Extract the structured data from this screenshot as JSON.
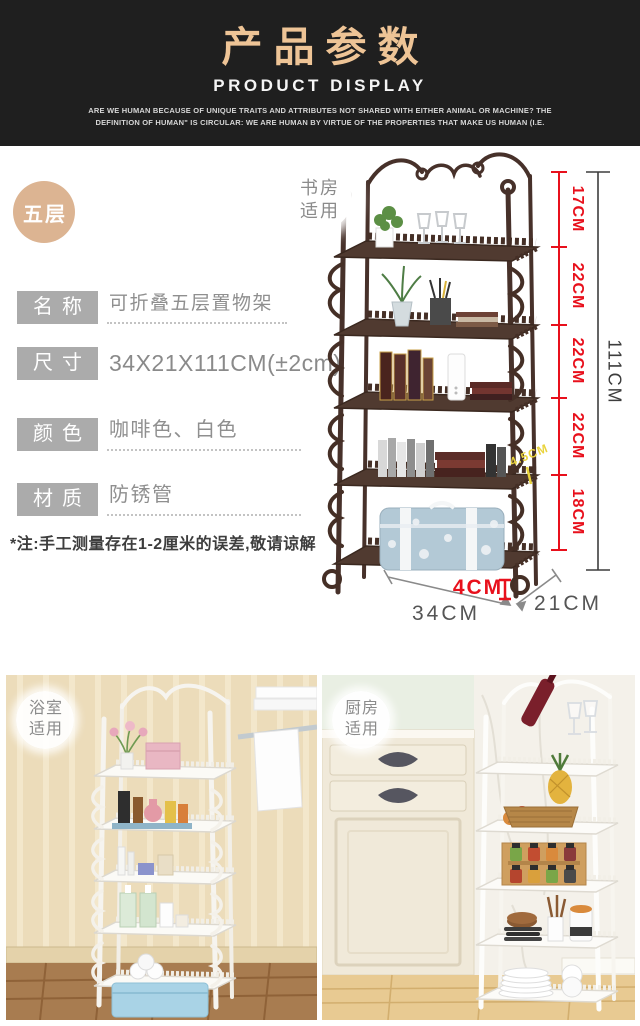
{
  "header": {
    "title": "产品参数",
    "subtitle": "PRODUCT DISPLAY",
    "description": "ARE WE HUMAN BECAUSE OF UNIQUE TRAITS AND ATTRIBUTES NOT SHARED WITH EITHER ANIMAL OR MACHINE? THE DEFINITION OF HUMAN\" IS CIRCULAR: WE ARE HUMAN BY VIRTUE OF THE PROPERTIES THAT MAKE US HUMAN (I.E."
  },
  "tier_badge": "五层",
  "specs": {
    "rows": [
      {
        "label": "名称",
        "value": "可折叠五层置物架"
      },
      {
        "label": "尺寸",
        "value": "34X21X111CM(±2cm)"
      },
      {
        "label": "颜色",
        "value": "咖啡色、白色"
      },
      {
        "label": "材质",
        "value": "防锈管"
      }
    ],
    "note": "*注:手工测量存在1-2厘米的误差,敬请谅解"
  },
  "product_figure": {
    "scene_tag": {
      "line1": "书房",
      "line2": "适用"
    },
    "tier_heights": [
      "17CM",
      "22CM",
      "22CM",
      "22CM",
      "18CM"
    ],
    "total_height": "111CM",
    "width": "34CM",
    "depth": "21CM",
    "foot_height": "4CM",
    "rail_height": "4.5CM"
  },
  "photos": {
    "bathroom": {
      "tag_line1": "浴室",
      "tag_line2": "适用"
    },
    "kitchen": {
      "tag_line1": "厨房",
      "tag_line2": "适用"
    }
  },
  "colors": {
    "accent_red": "#e8101c",
    "title_tan": "#eec496",
    "badge_tan": "#dcb492",
    "label_gray": "#ababab",
    "highlight_yellow": "#e9d33c",
    "shelf_coffee": "#4a332a"
  }
}
